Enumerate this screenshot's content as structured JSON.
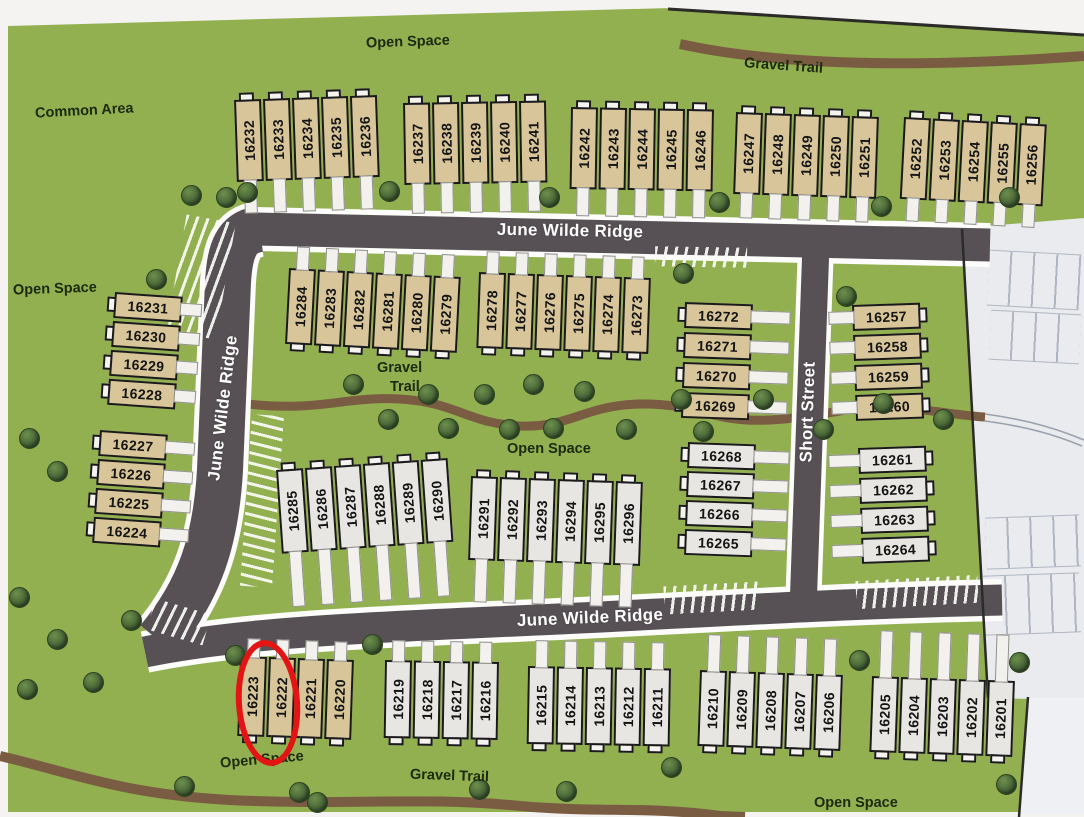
{
  "map": {
    "colors": {
      "green": "#92b050",
      "road": "#575156",
      "road_casing": "#fcfcfa",
      "trail": "#7a5c42",
      "lot_tan": "#d8c59a",
      "lot_white": "#e8e6e2",
      "highlight_red": "#e31414",
      "tree": "#3c5831"
    },
    "highlight": {
      "lot": "16223",
      "x": 236,
      "y": 640,
      "w": 52,
      "h": 114,
      "rot": -4
    },
    "area_labels": [
      {
        "text": "Open Space",
        "x": 366,
        "y": 34,
        "rot": -2
      },
      {
        "text": "Gravel Trail",
        "x": 744,
        "y": 58,
        "rot": 4
      },
      {
        "text": "Common Area",
        "x": 35,
        "y": 103,
        "rot": -3
      },
      {
        "text": "Open Space",
        "x": 13,
        "y": 281,
        "rot": -2
      },
      {
        "text": "Gravel",
        "x": 377,
        "y": 360,
        "rot": 0
      },
      {
        "text": "Trail",
        "x": 390,
        "y": 379,
        "rot": 0
      },
      {
        "text": "Open Space",
        "x": 507,
        "y": 441,
        "rot": 0
      },
      {
        "text": "Open Space",
        "x": 220,
        "y": 752,
        "rot": -5
      },
      {
        "text": "Gravel Trail",
        "x": 410,
        "y": 768,
        "rot": 2
      },
      {
        "text": "Open Space",
        "x": 814,
        "y": 795,
        "rot": 0
      }
    ],
    "streets": [
      {
        "name": "June Wilde Ridge",
        "cx": 570,
        "cy": 231,
        "rot": 1
      },
      {
        "name": "June Wilde Ridge",
        "cx": 223,
        "cy": 408,
        "rot": -83
      },
      {
        "name": "June Wilde Ridge",
        "cx": 590,
        "cy": 618,
        "rot": -2.5
      },
      {
        "name": "Short Street",
        "cx": 808,
        "cy": 412,
        "rot": -88
      }
    ],
    "lot_groups": [
      {
        "id": "A",
        "type": "v",
        "fill": "tan",
        "x": 234,
        "y": 100,
        "rot": -2,
        "pitch": 29,
        "h": 82,
        "drive": "down",
        "dlen": 34,
        "numbers": [
          "16232",
          "16233",
          "16234",
          "16235",
          "16236"
        ]
      },
      {
        "id": "B",
        "type": "v",
        "fill": "tan",
        "x": 403,
        "y": 103,
        "rot": -1,
        "pitch": 29,
        "h": 82,
        "drive": "down",
        "dlen": 31,
        "numbers": [
          "16237",
          "16238",
          "16239",
          "16240",
          "16241"
        ]
      },
      {
        "id": "C",
        "type": "v",
        "fill": "tan",
        "x": 571,
        "y": 107,
        "rot": 1,
        "pitch": 29,
        "h": 82,
        "drive": "down",
        "dlen": 29,
        "numbers": [
          "16242",
          "16243",
          "16244",
          "16245",
          "16246"
        ]
      },
      {
        "id": "D",
        "type": "v",
        "fill": "tan",
        "x": 736,
        "y": 112,
        "rot": 2,
        "pitch": 29,
        "h": 82,
        "drive": "down",
        "dlen": 26,
        "numbers": [
          "16247",
          "16248",
          "16249",
          "16250",
          "16251"
        ]
      },
      {
        "id": "E",
        "type": "v",
        "fill": "tan",
        "x": 904,
        "y": 117,
        "rot": 3,
        "pitch": 29,
        "h": 82,
        "drive": "down",
        "dlen": 24,
        "numbers": [
          "16252",
          "16253",
          "16254",
          "16255",
          "16256"
        ]
      },
      {
        "id": "F",
        "type": "h",
        "fill": "tan",
        "x": 115,
        "y": 292,
        "rot": 4,
        "pitch": 29,
        "w": 68,
        "drive": "right",
        "dlen": 22,
        "numbers": [
          "16231",
          "16230",
          "16229",
          "16228"
        ]
      },
      {
        "id": "G",
        "type": "h",
        "fill": "tan",
        "x": 100,
        "y": 430,
        "rot": 4,
        "pitch": 29,
        "w": 68,
        "drive": "right",
        "dlen": 30,
        "numbers": [
          "16227",
          "16226",
          "16225",
          "16224"
        ]
      },
      {
        "id": "H",
        "type": "v",
        "fill": "tan",
        "x": 289,
        "y": 268,
        "rot": 3,
        "pitch": 29,
        "h": 76,
        "drive": "up",
        "dlen": 24,
        "numbers": [
          "16284",
          "16283",
          "16282",
          "16281",
          "16280",
          "16279"
        ]
      },
      {
        "id": "I",
        "type": "v",
        "fill": "tan",
        "x": 479,
        "y": 272,
        "rot": 2,
        "pitch": 29,
        "h": 76,
        "drive": "up",
        "dlen": 23,
        "numbers": [
          "16278",
          "16277",
          "16276",
          "16275",
          "16274",
          "16273"
        ]
      },
      {
        "id": "J",
        "type": "h",
        "fill": "tan",
        "x": 685,
        "y": 302,
        "rot": 2,
        "pitch": 30,
        "w": 68,
        "drive": "right",
        "dlen": 40,
        "numbers": [
          "16272",
          "16271",
          "16270",
          "16269"
        ]
      },
      {
        "id": "K",
        "type": "h",
        "fill": "tan",
        "x": 852,
        "y": 305,
        "rot": -2,
        "pitch": 30,
        "w": 68,
        "drive": "left",
        "dlen": 26,
        "numbers": [
          "16257",
          "16258",
          "16259",
          "16260"
        ]
      },
      {
        "id": "L",
        "type": "h",
        "fill": "wht",
        "x": 688,
        "y": 442,
        "rot": 2,
        "pitch": 29,
        "w": 68,
        "drive": "right",
        "dlen": 36,
        "numbers": [
          "16268",
          "16267",
          "16266",
          "16265"
        ]
      },
      {
        "id": "M",
        "type": "h",
        "fill": "wht",
        "x": 858,
        "y": 448,
        "rot": -2,
        "pitch": 30,
        "w": 68,
        "drive": "left",
        "dlen": 32,
        "numbers": [
          "16261",
          "16262",
          "16263",
          "16264"
        ]
      },
      {
        "id": "N",
        "type": "v",
        "fill": "wht",
        "x": 276,
        "y": 470,
        "rot": -4,
        "pitch": 29,
        "h": 84,
        "drive": "down",
        "dlen": 56,
        "numbers": [
          "16285",
          "16286",
          "16287",
          "16288",
          "16289",
          "16290"
        ]
      },
      {
        "id": "O",
        "type": "v",
        "fill": "wht",
        "x": 471,
        "y": 476,
        "rot": 2,
        "pitch": 29,
        "h": 84,
        "drive": "down",
        "dlen": 44,
        "numbers": [
          "16291",
          "16292",
          "16293",
          "16294",
          "16295",
          "16296"
        ]
      },
      {
        "id": "P",
        "type": "v",
        "fill": "tan",
        "x": 240,
        "y": 656,
        "rot": 2,
        "pitch": 29,
        "h": 80,
        "drive": "up",
        "dlen": 20,
        "numbers": [
          "16223",
          "16222",
          "16221",
          "16220"
        ]
      },
      {
        "id": "Q",
        "type": "v",
        "fill": "wht",
        "x": 385,
        "y": 660,
        "rot": 1,
        "pitch": 29,
        "h": 78,
        "drive": "up",
        "dlen": 22,
        "numbers": [
          "16219",
          "16218",
          "16217",
          "16216"
        ]
      },
      {
        "id": "R",
        "type": "v",
        "fill": "wht",
        "x": 528,
        "y": 666,
        "rot": 1,
        "pitch": 29,
        "h": 78,
        "drive": "up",
        "dlen": 28,
        "numbers": [
          "16215",
          "16214",
          "16213",
          "16212",
          "16211"
        ]
      },
      {
        "id": "S",
        "type": "v",
        "fill": "wht",
        "x": 700,
        "y": 670,
        "rot": 2,
        "pitch": 29,
        "h": 76,
        "drive": "up",
        "dlen": 38,
        "numbers": [
          "16210",
          "16209",
          "16208",
          "16207",
          "16206"
        ]
      },
      {
        "id": "T",
        "type": "v",
        "fill": "wht",
        "x": 872,
        "y": 676,
        "rot": 2,
        "pitch": 29,
        "h": 76,
        "drive": "up",
        "dlen": 48,
        "numbers": [
          "16205",
          "16204",
          "16203",
          "16202",
          "16201"
        ]
      }
    ],
    "trees": [
      [
        225,
        196
      ],
      [
        388,
        190
      ],
      [
        548,
        196
      ],
      [
        718,
        201
      ],
      [
        880,
        205
      ],
      [
        1008,
        196
      ],
      [
        190,
        194
      ],
      [
        246,
        191
      ],
      [
        155,
        278
      ],
      [
        28,
        437
      ],
      [
        56,
        470
      ],
      [
        18,
        596
      ],
      [
        56,
        638
      ],
      [
        26,
        688
      ],
      [
        92,
        681
      ],
      [
        130,
        619
      ],
      [
        352,
        383
      ],
      [
        387,
        418
      ],
      [
        427,
        393
      ],
      [
        447,
        427
      ],
      [
        483,
        393
      ],
      [
        508,
        428
      ],
      [
        532,
        383
      ],
      [
        552,
        427
      ],
      [
        583,
        390
      ],
      [
        625,
        428
      ],
      [
        680,
        398
      ],
      [
        702,
        430
      ],
      [
        762,
        398
      ],
      [
        822,
        428
      ],
      [
        882,
        402
      ],
      [
        942,
        418
      ],
      [
        845,
        295
      ],
      [
        682,
        272
      ],
      [
        371,
        643
      ],
      [
        234,
        654
      ],
      [
        858,
        659
      ],
      [
        1018,
        661
      ],
      [
        183,
        785
      ],
      [
        298,
        791
      ],
      [
        316,
        801
      ],
      [
        478,
        788
      ],
      [
        565,
        790
      ],
      [
        670,
        766
      ],
      [
        1005,
        783
      ]
    ]
  }
}
